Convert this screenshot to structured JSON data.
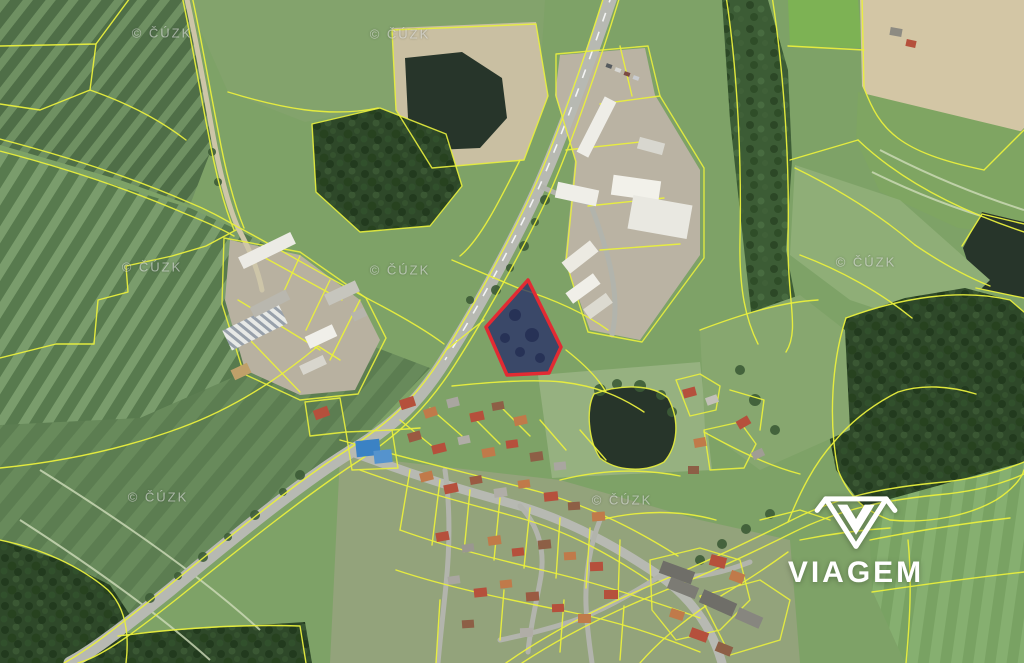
{
  "palette": {
    "cadastral_line": "#e9ef3d",
    "road_gray": "#b7b9b2",
    "highlight_stroke": "#e22b33",
    "highlight_fill": "rgba(32,38,105,0.72)",
    "water_dark": "#27352a",
    "blue_roof": "#3b82c4",
    "logo_white": "#ffffff"
  },
  "watermark": {
    "text": "© ČÚZK",
    "positions": [
      {
        "x": 162,
        "y": 33
      },
      {
        "x": 400,
        "y": 34
      },
      {
        "x": 152,
        "y": 267
      },
      {
        "x": 400,
        "y": 270
      },
      {
        "x": 866,
        "y": 262
      },
      {
        "x": 158,
        "y": 497
      },
      {
        "x": 622,
        "y": 500
      }
    ]
  },
  "logo": {
    "text": "VIAGEM",
    "icon": "viagem-gem-icon"
  },
  "highlight_parcel": {
    "points": "528,280 561,347 549,373 507,375 486,327",
    "stroke": "#e22b33",
    "fill": "rgba(32,38,105,0.72)"
  },
  "buildings": {
    "industrial": [
      [
        238,
        244,
        58,
        13,
        -26,
        "#ecebe5"
      ],
      [
        224,
        316,
        62,
        22,
        -26,
        "url(#solar)"
      ],
      [
        250,
        298,
        40,
        11,
        -27,
        "#b9b7ae"
      ],
      [
        306,
        330,
        30,
        13,
        -25,
        "#f0efe9"
      ],
      [
        325,
        287,
        34,
        12,
        -25,
        "#c6c5bd"
      ],
      [
        300,
        360,
        26,
        10,
        -25,
        "#d8d6cd"
      ],
      [
        352,
        310,
        14,
        9,
        -25,
        "#b7b5ac"
      ],
      [
        232,
        366,
        18,
        11,
        -25,
        "#c0a06a"
      ],
      [
        590,
        96,
        13,
        62,
        27,
        "#eeede7"
      ],
      [
        556,
        186,
        42,
        16,
        12,
        "#efeee8"
      ],
      [
        612,
        178,
        48,
        20,
        8,
        "#f2f1ea"
      ],
      [
        630,
        200,
        60,
        34,
        10,
        "#e9e8e1"
      ],
      [
        638,
        140,
        26,
        12,
        15,
        "#d8d7cf"
      ],
      [
        562,
        250,
        36,
        14,
        -38,
        "#eceae2"
      ],
      [
        566,
        282,
        34,
        13,
        -36,
        "#f0efe8"
      ],
      [
        584,
        300,
        28,
        12,
        -36,
        "#dcdad0"
      ],
      [
        606,
        64,
        6,
        4,
        20,
        "#555a5e"
      ],
      [
        615,
        68,
        6,
        4,
        20,
        "#d8d8d4"
      ],
      [
        624,
        72,
        6,
        4,
        20,
        "#7a4a42"
      ],
      [
        633,
        76,
        6,
        4,
        20,
        "#c9ccd0"
      ]
    ],
    "landmark_blue": [
      [
        356,
        440,
        24,
        16,
        -6,
        "#3b82c4"
      ],
      [
        374,
        450,
        18,
        13,
        -6,
        "#5593cd"
      ]
    ],
    "residential": [
      [
        314,
        408,
        15,
        10,
        -20,
        "#b5503c"
      ],
      [
        683,
        388,
        13,
        9,
        -15,
        "#b5503c"
      ],
      [
        706,
        396,
        12,
        8,
        -20,
        "#c2c0b8"
      ],
      [
        737,
        418,
        13,
        9,
        -30,
        "#b5503c"
      ],
      [
        694,
        438,
        12,
        9,
        -10,
        "#c07a4a"
      ],
      [
        752,
        450,
        12,
        8,
        -25,
        "#a09d94"
      ],
      [
        688,
        466,
        11,
        8,
        0,
        "#8d5f46"
      ],
      [
        400,
        398,
        15,
        10,
        -18,
        "#b5503c"
      ],
      [
        424,
        408,
        13,
        9,
        -18,
        "#c07a4a"
      ],
      [
        447,
        398,
        12,
        9,
        -14,
        "#a9a6a0"
      ],
      [
        470,
        412,
        14,
        9,
        -12,
        "#b5503c"
      ],
      [
        492,
        402,
        12,
        8,
        -10,
        "#8d5f46"
      ],
      [
        514,
        416,
        13,
        9,
        -12,
        "#c07a4a"
      ],
      [
        408,
        432,
        13,
        9,
        -16,
        "#9a5a42"
      ],
      [
        432,
        444,
        14,
        9,
        -14,
        "#b5503c"
      ],
      [
        458,
        436,
        12,
        8,
        -12,
        "#b0ada6"
      ],
      [
        482,
        448,
        13,
        9,
        -10,
        "#c07a4a"
      ],
      [
        506,
        440,
        12,
        8,
        -8,
        "#b5503c"
      ],
      [
        530,
        452,
        13,
        9,
        -8,
        "#8d5f46"
      ],
      [
        554,
        462,
        12,
        8,
        -6,
        "#a9a6a0"
      ],
      [
        420,
        472,
        13,
        9,
        -14,
        "#c07a4a"
      ],
      [
        444,
        484,
        14,
        9,
        -12,
        "#b5503c"
      ],
      [
        470,
        476,
        12,
        8,
        -10,
        "#9a5a42"
      ],
      [
        494,
        488,
        13,
        9,
        -8,
        "#b0ada6"
      ],
      [
        518,
        480,
        12,
        8,
        -8,
        "#c07a4a"
      ],
      [
        544,
        492,
        14,
        9,
        -6,
        "#b5503c"
      ],
      [
        568,
        502,
        12,
        8,
        -4,
        "#8d5f46"
      ],
      [
        592,
        512,
        13,
        9,
        -4,
        "#c07a4a"
      ],
      [
        436,
        532,
        13,
        9,
        -10,
        "#b5503c"
      ],
      [
        462,
        544,
        12,
        8,
        -8,
        "#9a9790"
      ],
      [
        488,
        536,
        13,
        9,
        -8,
        "#c07a4a"
      ],
      [
        512,
        548,
        12,
        8,
        -6,
        "#b5503c"
      ],
      [
        538,
        540,
        13,
        9,
        -6,
        "#8d5f46"
      ],
      [
        564,
        552,
        12,
        8,
        -4,
        "#c07a4a"
      ],
      [
        590,
        562,
        13,
        9,
        -2,
        "#b5503c"
      ],
      [
        448,
        576,
        12,
        8,
        -8,
        "#a9a6a0"
      ],
      [
        474,
        588,
        13,
        9,
        -6,
        "#b5503c"
      ],
      [
        500,
        580,
        12,
        8,
        -6,
        "#c07a4a"
      ],
      [
        526,
        592,
        13,
        9,
        -4,
        "#9a5a42"
      ],
      [
        552,
        604,
        12,
        8,
        -2,
        "#b5503c"
      ],
      [
        578,
        614,
        13,
        9,
        0,
        "#c07a4a"
      ],
      [
        462,
        620,
        12,
        8,
        -4,
        "#8d5f46"
      ],
      [
        520,
        628,
        13,
        9,
        -2,
        "#b0ada6"
      ],
      [
        604,
        590,
        14,
        9,
        0,
        "#b5503c"
      ],
      [
        660,
        566,
        34,
        13,
        20,
        "#6f6e68"
      ],
      [
        668,
        582,
        30,
        12,
        22,
        "#7c7b74"
      ],
      [
        700,
        596,
        36,
        14,
        24,
        "#6f6e68"
      ],
      [
        710,
        556,
        16,
        11,
        15,
        "#b5503c"
      ],
      [
        730,
        572,
        14,
        10,
        20,
        "#c07a4a"
      ],
      [
        736,
        612,
        26,
        12,
        24,
        "#87867f"
      ],
      [
        690,
        630,
        18,
        10,
        20,
        "#b5503c"
      ],
      [
        716,
        644,
        16,
        10,
        22,
        "#8d5f46"
      ],
      [
        670,
        610,
        14,
        9,
        18,
        "#c07a4a"
      ],
      [
        890,
        28,
        12,
        8,
        10,
        "#8d8b82"
      ],
      [
        906,
        40,
        10,
        7,
        12,
        "#b5503c"
      ]
    ]
  }
}
